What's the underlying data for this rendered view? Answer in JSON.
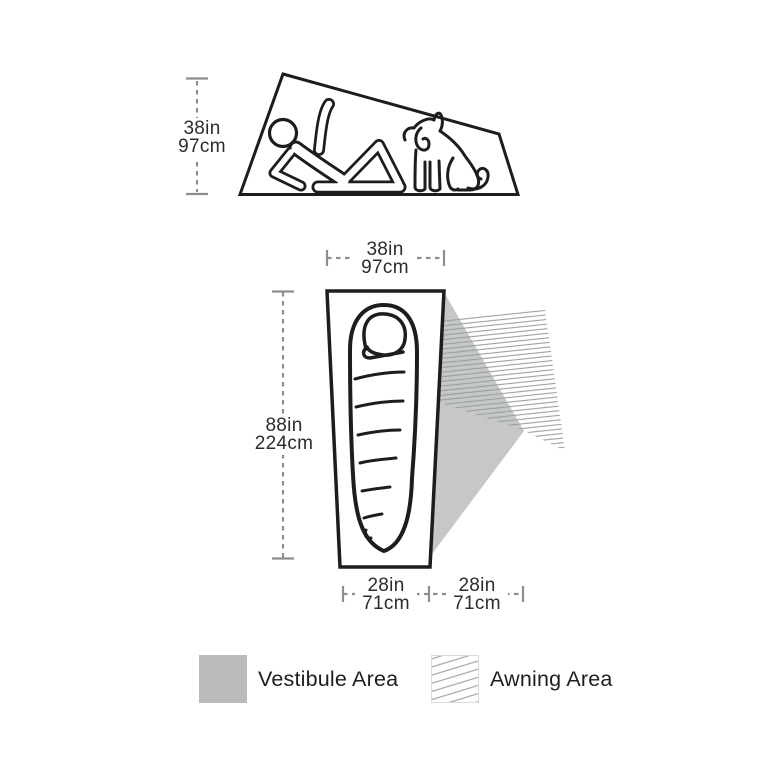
{
  "diagram": {
    "title": "tent-dimensions-diagram",
    "side_view": {
      "height": {
        "inches": "38in",
        "cm": "97cm"
      }
    },
    "floor_plan": {
      "head_width": {
        "inches": "38in",
        "cm": "97cm"
      },
      "length": {
        "inches": "88in",
        "cm": "224cm"
      },
      "foot_width": {
        "inches": "28in",
        "cm": "71cm"
      },
      "vestibule_width": {
        "inches": "28in",
        "cm": "71cm"
      }
    },
    "legend": [
      {
        "swatch": "vestibule-swatch",
        "label": "Vestibule Area"
      },
      {
        "swatch": "awning-swatch",
        "label": "Awning Area"
      }
    ],
    "icons": [
      "person-reclining-icon",
      "dog-sitting-icon",
      "sleeping-bag-icon",
      "tent-side-outline",
      "tent-floor-outline"
    ],
    "colors": {
      "line_black": "#1d1d1b",
      "dimension_gray": "#8c8e90",
      "text": "#2c2c2c",
      "vestibule_fill": "#c5c7c8",
      "legend_vestibule_fill": "#b9bbbc",
      "hatch_line": "#9b9ea0",
      "background": "#ffffff"
    }
  }
}
